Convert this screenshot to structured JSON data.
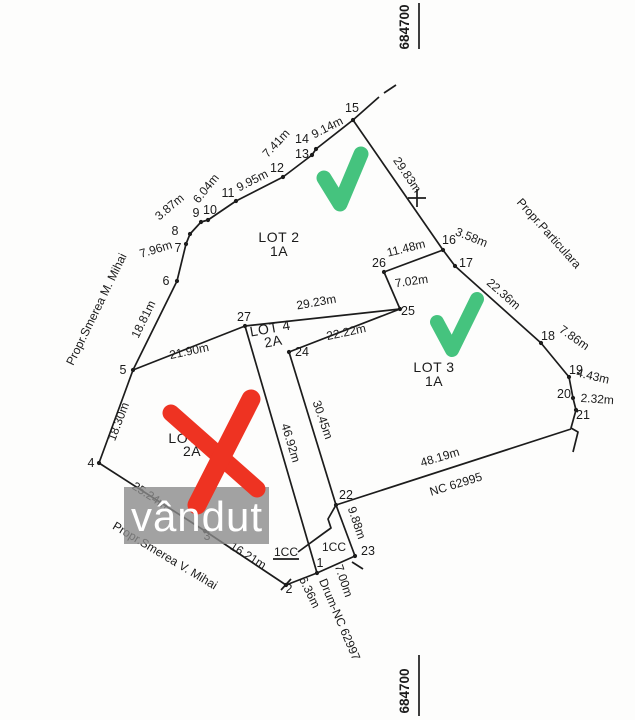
{
  "map": {
    "grid_labels": {
      "top": "684700",
      "bottom": "684700"
    },
    "lots": {
      "lot1": {
        "name": "LOT 1",
        "parcel": "2A"
      },
      "lot2": {
        "name": "LOT 2",
        "parcel": "1A"
      },
      "lot3": {
        "name": "LOT 3",
        "parcel": "1A"
      },
      "lot4": {
        "name": "LOT 4",
        "parcel": "2A"
      }
    },
    "neighbors": {
      "west": "Propr.Smerea M. Mihai",
      "south": "Propr.Smerea V. Mihai",
      "east": "Propr.Particulara"
    },
    "road_label": "Drum-NC 62997",
    "adjacent_parcel": "NC 62995",
    "land_use_left": "1CC",
    "land_use_right": "1CC",
    "points": {
      "p1": "1",
      "p2": "2",
      "p3": "3",
      "p4": "4",
      "p5": "5",
      "p6": "6",
      "p7": "7",
      "p8": "8",
      "p9": "9",
      "p10": "10",
      "p11": "11",
      "p12": "12",
      "p13": "13",
      "p14": "14",
      "p15": "15",
      "p16": "16",
      "p17": "17",
      "p18": "18",
      "p19": "19",
      "p20": "20",
      "p21": "21",
      "p22": "22",
      "p23": "23",
      "p24": "24",
      "p25": "25",
      "p26": "26",
      "p27": "27"
    },
    "measurements": {
      "m_4_5": "18.30m",
      "m_5_6": "18.81m",
      "m_6_7": "7.96m",
      "m_8_9": "3.87m",
      "m_10_11": "6.04m",
      "m_11_12": "9.95m",
      "m_12_13": "7.41m",
      "m_14_15": "9.14m",
      "m_15_16": "29.83m",
      "m_16_17": "3.58m",
      "m_26_16": "11.48m",
      "m_26_25": "7.02m",
      "m_17_18": "22.36m",
      "m_18_19": "7.86m",
      "m_19_20": "4.43m",
      "m_20_21": "2.32m",
      "m_21_22": "48.19m",
      "m_27_25": "29.23m",
      "m_24_25": "22.22m",
      "m_5_27": "21.90m",
      "m_24_22": "30.45m",
      "m_27_1": "46.92m",
      "m_22_23": "9.88m",
      "m_23_1": "7.00m",
      "m_1_2": "6.36m",
      "m_2_3": "16.21m",
      "m_3_4": "25.24m"
    }
  },
  "overlays": {
    "sold_text": "vândut",
    "sold_box_color": "#8b8b8b",
    "check_color": "#45c37e",
    "cross_color": "#ee3322"
  }
}
